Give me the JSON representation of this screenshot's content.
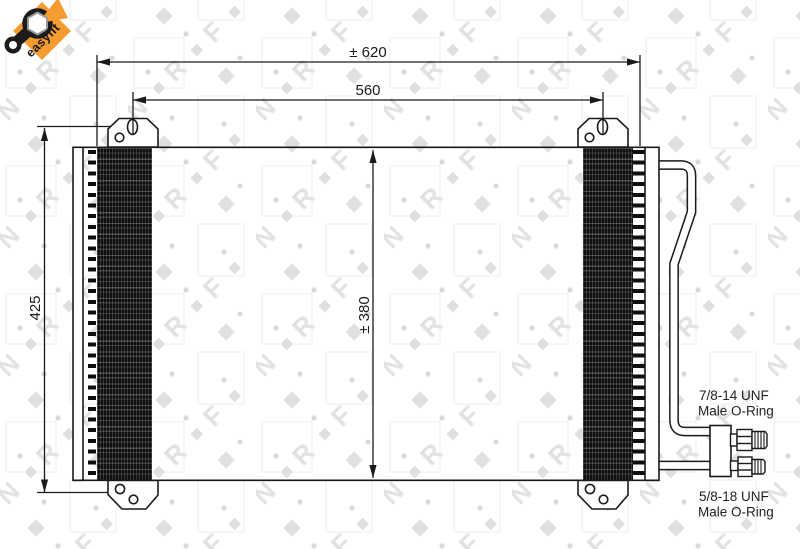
{
  "badge": {
    "label": "easyfit"
  },
  "watermark": {
    "letters": [
      "N",
      "R",
      "F"
    ]
  },
  "dimensions": {
    "overall_width": "± 620",
    "mounting_width": "560",
    "overall_height": "425",
    "core_height": "± 380"
  },
  "connections": {
    "upper": {
      "thread": "7/8-14 UNF",
      "type": "Male O-Ring"
    },
    "lower": {
      "thread": "5/8-18 UNF",
      "type": "Male O-Ring"
    }
  },
  "colors": {
    "badge_orange": "#F59C30",
    "line_black": "#1a1a1a",
    "watermark_gray": "#dfdfdf"
  }
}
